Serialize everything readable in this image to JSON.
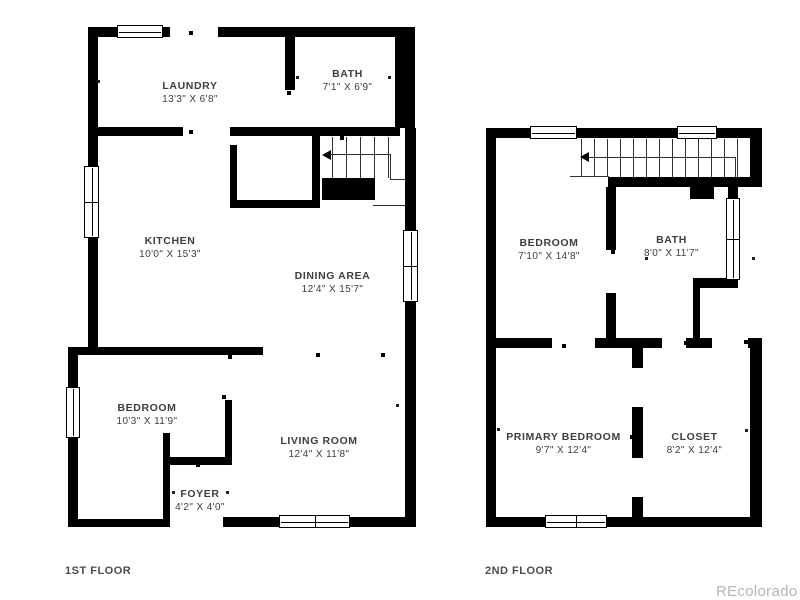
{
  "floors": [
    {
      "caption": "1ST FLOOR",
      "rooms": [
        {
          "name": "LAUNDRY",
          "dims": "13'3\" X 6'8\""
        },
        {
          "name": "BATH",
          "dims": "7'1\" X 6'9\""
        },
        {
          "name": "KITCHEN",
          "dims": "10'0\" X 15'3\""
        },
        {
          "name": "DINING AREA",
          "dims": "12'4\" X 15'7\""
        },
        {
          "name": "BEDROOM",
          "dims": "10'3\" X 11'9\""
        },
        {
          "name": "LIVING ROOM",
          "dims": "12'4\" X 11'8\""
        },
        {
          "name": "FOYER",
          "dims": "4'2\" X 4'0\""
        }
      ]
    },
    {
      "caption": "2ND FLOOR",
      "rooms": [
        {
          "name": "BEDROOM",
          "dims": "7'10\" X 14'8\""
        },
        {
          "name": "BATH",
          "dims": "8'0\" X 11'7\""
        },
        {
          "name": "PRIMARY BEDROOM",
          "dims": "9'7\" X 12'4\""
        },
        {
          "name": "CLOSET",
          "dims": "8'2\" X 12'4\""
        }
      ]
    }
  ],
  "watermark": "REcolorado",
  "colors": {
    "wall": "#000000",
    "label": "#3e3e3e",
    "caption": "#4c4c4c",
    "watermark": "#b5b5b5"
  }
}
